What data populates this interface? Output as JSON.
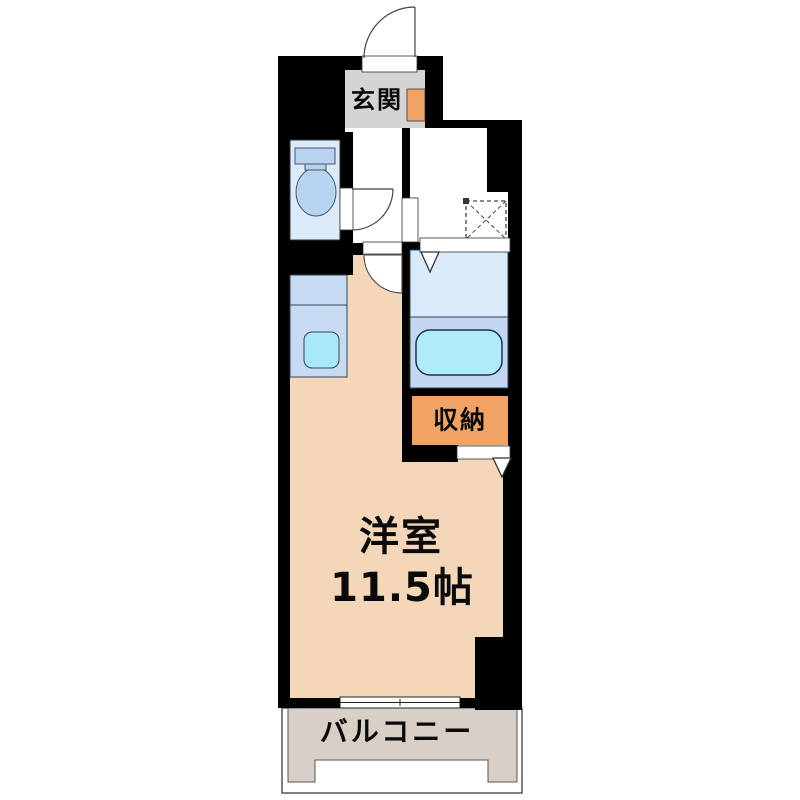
{
  "floorplan": {
    "rooms": {
      "entrance": {
        "label": "玄関"
      },
      "western_room": {
        "label": "洋室",
        "size": "11.5帖"
      },
      "storage": {
        "label": "収納"
      },
      "balcony": {
        "label": "バルコニー"
      }
    },
    "colors": {
      "wall": "#000000",
      "outline": "#333333",
      "room_floor": "#f4d6b8",
      "entrance_floor": "#d4d4d4",
      "accent_orange": "#f0a364",
      "toilet_floor": "#dcebfa",
      "fixture_blue": "#b7d3f0",
      "kitchen_counter": "#c6dbf3",
      "sink_cyan": "#a9e8f6",
      "bath_floor_upper": "#d9eaf8",
      "bath_floor_lower": "#c3d8f0",
      "bathtub_cyan": "#b0ecf8",
      "balcony_floor": "#d8cfc8",
      "white": "#ffffff"
    }
  }
}
